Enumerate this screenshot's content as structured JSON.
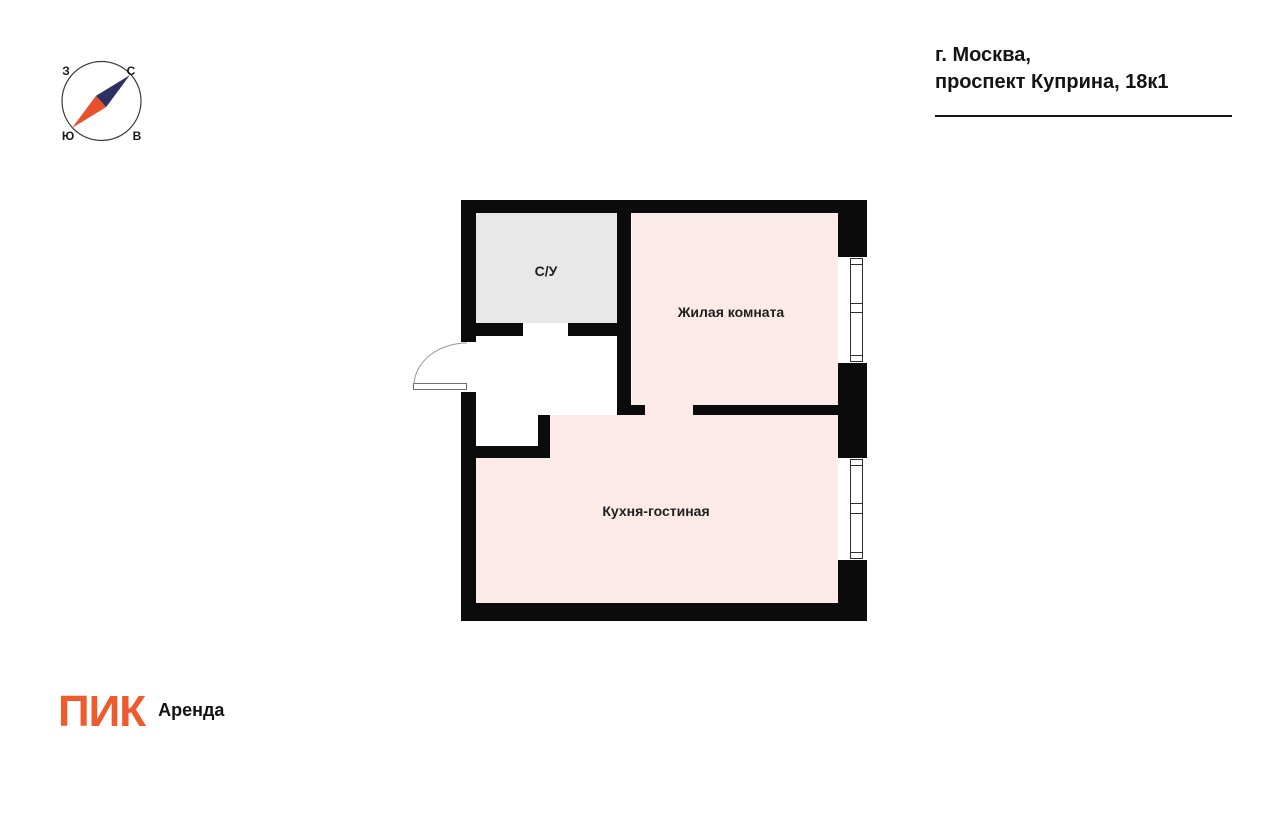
{
  "address": {
    "line1": "г. Москва,",
    "line2": "проспект Куприна, 18к1"
  },
  "compass": {
    "labels": {
      "north": "С",
      "east": "В",
      "south": "Ю",
      "west": "З"
    },
    "colors": {
      "north_needle": "#2D3061",
      "south_needle": "#E8512B",
      "ring": "#3A3A3A"
    }
  },
  "floorplan": {
    "wall_color": "#0B0B0B",
    "rooms": [
      {
        "id": "bathroom",
        "label": "С/У",
        "fill": "#E8E8E8"
      },
      {
        "id": "living-room",
        "label": "Жилая комната",
        "fill": "#FBEAE7"
      },
      {
        "id": "kitchen-living-room",
        "label": "Кухня-гостиная",
        "fill": "#FBEAE7"
      }
    ]
  },
  "footer": {
    "logo_text": "ПИК",
    "logo_color": "#ED5B2F",
    "product_label": "Аренда"
  }
}
